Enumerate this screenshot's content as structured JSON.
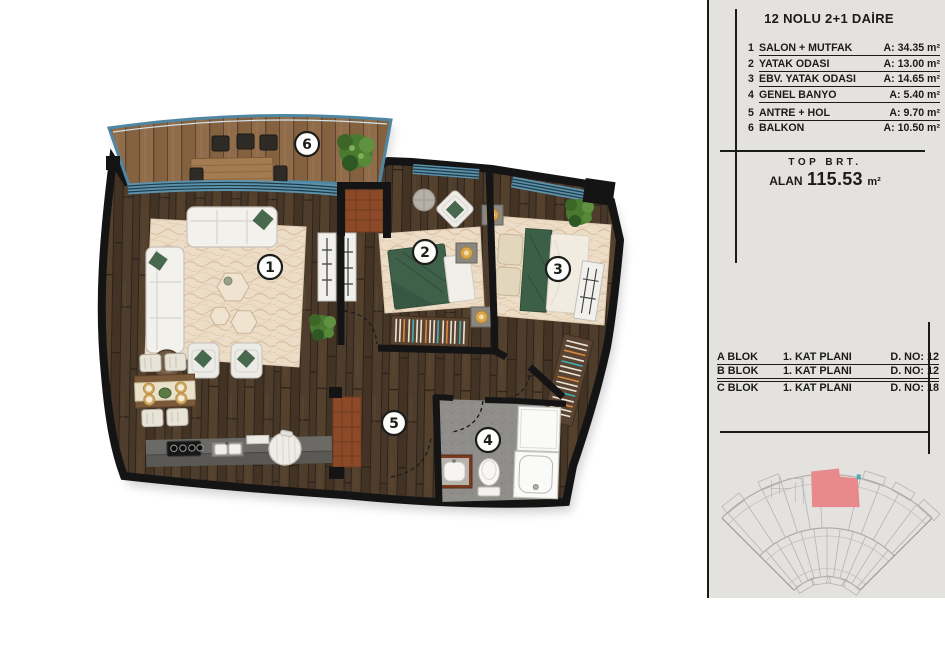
{
  "legend": {
    "title": "12 NOLU 2+1 DAİRE",
    "rooms": [
      {
        "no": "1",
        "label": "SALON + MUTFAK",
        "area": "A: 34.35 m²"
      },
      {
        "no": "2",
        "label": "YATAK ODASI",
        "area": "A: 13.00 m²"
      },
      {
        "no": "3",
        "label": "EBV. YATAK ODASI",
        "area": "A: 14.65 m²"
      },
      {
        "no": "4",
        "label": "GENEL BANYO",
        "area": "A: 5.40 m²"
      },
      {
        "no": "5",
        "label": "ANTRE + HOL",
        "area": "A: 9.70 m²"
      },
      {
        "no": "6",
        "label": "BALKON",
        "area": "A: 10.50 m²"
      }
    ]
  },
  "summary": {
    "top_label": "TOP BRT.",
    "alan_label": "ALAN",
    "value": "115.53",
    "unit": "m²"
  },
  "blocks": {
    "rows": [
      {
        "block": "A BLOK",
        "plan": "1. KAT PLANI",
        "flat": "D. NO: 12"
      },
      {
        "block": "B BLOK",
        "plan": "1. KAT PLANI",
        "flat": "D. NO: 12"
      },
      {
        "block": "C BLOK",
        "plan": "1. KAT PLANI",
        "flat": "D. NO: 18"
      }
    ]
  },
  "colors": {
    "wall": "#141414",
    "wood_floor": "#4a3a2b",
    "balcony_deck": "#8b6747",
    "accent_teal": "#4f86a2",
    "rug": "#eddcc6",
    "green_textile": "#3f6149",
    "bathroom_floor": "#8f8e8a",
    "door_wood": "#8d4a28",
    "panel_bg": "#e3e2df",
    "site_highlight": "#e8898b"
  }
}
